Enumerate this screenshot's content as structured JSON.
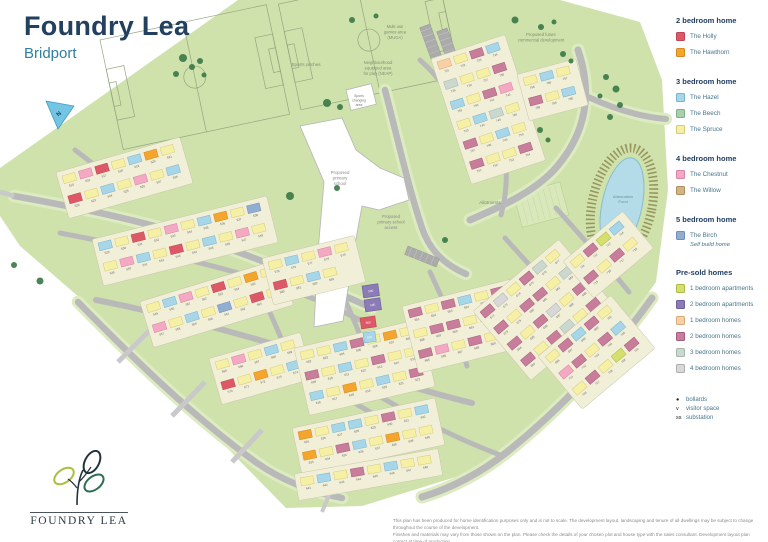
{
  "header": {
    "title": "Foundry Lea",
    "subtitle": "Bridport"
  },
  "legend": {
    "sections": [
      {
        "heading": "2 bedroom home",
        "items": [
          {
            "key": "holly",
            "label": "The Holly"
          },
          {
            "key": "hawthorn",
            "label": "The Hawthorn"
          }
        ]
      },
      {
        "heading": "3 bedroom home",
        "items": [
          {
            "key": "hazel",
            "label": "The Hazel"
          },
          {
            "key": "beech",
            "label": "The Beech"
          },
          {
            "key": "spruce",
            "label": "The Spruce"
          }
        ]
      },
      {
        "heading": "4 bedroom home",
        "items": [
          {
            "key": "chestnut",
            "label": "The Chestnut"
          },
          {
            "key": "willow",
            "label": "The Willow"
          }
        ]
      },
      {
        "heading": "5 bedroom home",
        "items": [
          {
            "key": "birch",
            "label": "The Birch",
            "note": "Self build home"
          }
        ]
      },
      {
        "heading": "Pre-sold homes",
        "items": [
          {
            "key": "p1apt",
            "label": "1 bedroom apartments"
          },
          {
            "key": "p2apt",
            "label": "2 bedroom apartments"
          },
          {
            "key": "p1home",
            "label": "1 bedroom homes"
          },
          {
            "key": "p2home",
            "label": "2 bedroom homes"
          },
          {
            "key": "p3home",
            "label": "3 bedroom homes"
          },
          {
            "key": "p4home",
            "label": "4 bedroom homes"
          }
        ]
      }
    ],
    "markers": [
      {
        "sym": "●",
        "label": "bollards"
      },
      {
        "sym": "v",
        "label": "visitor space"
      },
      {
        "sym": "ss",
        "label": "substation"
      }
    ]
  },
  "colors": {
    "holly": {
      "f": "#dd5968",
      "s": "#c04552"
    },
    "hawthorn": {
      "f": "#f3a52d",
      "s": "#d68c1c"
    },
    "hazel": {
      "f": "#a7d6e8",
      "s": "#7ab4cc"
    },
    "beech": {
      "f": "#a9cfad",
      "s": "#7fb189"
    },
    "spruce": {
      "f": "#f6f0a6",
      "s": "#d5cb79"
    },
    "chestnut": {
      "f": "#f4a9c3",
      "s": "#d884a4"
    },
    "willow": {
      "f": "#d3b384",
      "s": "#b08f5e"
    },
    "birch": {
      "f": "#91aed1",
      "s": "#6f92b8"
    },
    "p1apt": {
      "f": "#d5df6e",
      "s": "#aeba46"
    },
    "p2apt": {
      "f": "#8b7cb7",
      "s": "#6d5f9a"
    },
    "p1home": {
      "f": "#f8cfa6",
      "s": "#d9ab7c"
    },
    "p2home": {
      "f": "#c87e9b",
      "s": "#a65d7d"
    },
    "p3home": {
      "f": "#cbd8d0",
      "s": "#a4b8ab"
    },
    "p4home": {
      "f": "#d8d8d8",
      "s": "#b0b0b0"
    }
  },
  "map": {
    "green": "#cfe2ac",
    "verge": "#dcebc0",
    "road": "#b9b9b9",
    "stub": "#c9c9c9",
    "parcel": "#f2efd8",
    "parcel_edge": "#c9c5a8",
    "pond": "#b4dce8",
    "pond_edge": "#86bdd1",
    "ring": "#98975e",
    "tree": "#3c7a47",
    "pitch_line": "#96a580",
    "site_outline": "238,0 560,0 640,22 662,80 668,190 656,282 600,360 540,430 472,472 362,506 286,508 80,298 20,246 0,216 0,168",
    "school_outline": "300,126 342,118 356,150 380,168 404,178 409,200 379,210 362,206 354,250 343,321 314,327 318,252 324,182",
    "north_label": "N",
    "labels": [
      {
        "lines": [
          "Sports pitches"
        ],
        "x": 306,
        "y": 66,
        "size": 4.6,
        "color": "#7d9070"
      },
      {
        "lines": [
          "Multi use",
          "games area",
          "(MUGA)"
        ],
        "x": 395,
        "y": 28,
        "size": 4.2,
        "color": "#7d9070"
      },
      {
        "lines": [
          "Neighbourhood",
          "equipped area",
          "for play (NEAP)"
        ],
        "x": 378,
        "y": 64,
        "size": 4.2,
        "color": "#7d9070"
      },
      {
        "lines": [
          "Sports",
          "changing",
          "area"
        ],
        "x": 359,
        "y": 97,
        "size": 3.4,
        "color": "#777777",
        "box": {
          "x": 346,
          "y": 90,
          "w": 26,
          "h": 21,
          "rot": -14
        }
      },
      {
        "lines": [
          "Proposed",
          "primary",
          "school"
        ],
        "x": 340,
        "y": 174,
        "size": 4.4,
        "color": "#8a8a8a"
      },
      {
        "lines": [
          "Proposed",
          "primary school",
          "access"
        ],
        "x": 391,
        "y": 218,
        "size": 4.2,
        "color": "#8a8a8a"
      },
      {
        "lines": [
          "Proposed future",
          "commercial development"
        ],
        "x": 541,
        "y": 36,
        "size": 4.2,
        "color": "#7d9070"
      },
      {
        "lines": [
          "Allotments"
        ],
        "x": 490,
        "y": 204,
        "size": 4.6,
        "color": "#7d9070"
      },
      {
        "lines": [
          "Attenuation",
          "Pond"
        ],
        "x": 623,
        "y": 198,
        "size": 4.0,
        "color": "#6f8f99"
      }
    ],
    "roads": [
      {
        "d": "M578,50 C592,92 588,132 554,170 C532,193 502,206 470,220",
        "w": 7,
        "verge": true
      },
      {
        "d": "M586,96 C616,110 642,117 666,119",
        "w": 6,
        "verge": true
      },
      {
        "d": "M385,90 C398,140 408,186 422,228 C429,249 443,264 466,274",
        "w": 6.5,
        "verge": true
      },
      {
        "d": "M14,196 C82,208 152,223 212,243 C272,263 322,286 372,308",
        "w": 6.5,
        "verge": true
      },
      {
        "d": "M75,150 C98,167 115,182 128,198",
        "w": 5
      },
      {
        "d": "M60,233 C122,245 192,259 252,277 C300,292 330,305 360,320",
        "w": 5
      },
      {
        "d": "M96,300 C162,313 232,331 302,353 C352,369 422,391 472,403",
        "w": 6
      },
      {
        "d": "M78,302 C132,357 192,416 257,463 C283,481 312,492 342,498",
        "w": 6.5,
        "verge": true
      },
      {
        "d": "M652,298 C612,354 562,408 507,452 C482,472 452,488 422,497",
        "w": 7,
        "verge": true
      },
      {
        "d": "M250,272 C266,302 279,332 291,363",
        "w": 5
      },
      {
        "d": "M345,300 C359,331 371,361 379,396",
        "w": 5
      },
      {
        "d": "M430,272 C444,302 457,332 467,366",
        "w": 5
      },
      {
        "d": "M505,238 C532,268 560,298 585,326",
        "w": 5
      },
      {
        "d": "M556,208 C582,237 608,266 629,292",
        "w": 5
      },
      {
        "d": "M420,60 C438,76 452,95 460,119",
        "w": 5
      },
      {
        "d": "M470,56 C487,79 497,103 501,128",
        "w": 5
      },
      {
        "d": "M501,128 C508,160 508,190 501,215",
        "w": 5
      },
      {
        "d": "M292,362 C330,390 380,420 430,442",
        "w": 5
      },
      {
        "d": "M379,396 C420,420 460,440 500,455",
        "w": 5
      },
      {
        "d": "M150,330 L118,362",
        "w": 5,
        "stub": true
      },
      {
        "d": "M205,382 L172,416",
        "w": 5,
        "stub": true
      },
      {
        "d": "M262,430 L232,462",
        "w": 5,
        "stub": true
      },
      {
        "d": "M332,488 L322,512",
        "w": 4,
        "stub": true
      },
      {
        "d": "M14,196 L0,192",
        "w": 5,
        "stub": true
      }
    ],
    "parking": [
      {
        "x": 430,
        "y": 24,
        "rot": 70,
        "w": 88,
        "h": 11
      },
      {
        "x": 447,
        "y": 28,
        "rot": 70,
        "w": 88,
        "h": 11
      },
      {
        "x": 408,
        "y": 246,
        "rot": 22,
        "w": 34,
        "h": 9
      }
    ],
    "clusters": [
      {
        "name": "west-upper",
        "x": 62,
        "y": 176,
        "rot": -16,
        "rows": 2,
        "cols": 7,
        "start": 515,
        "palette": [
          "spruce",
          "chestnut",
          "holly",
          "spruce",
          "hazel",
          "hawthorn",
          "spruce",
          "holly",
          "spruce",
          "hazel",
          "spruce",
          "chestnut",
          "spruce",
          "hazel"
        ]
      },
      {
        "name": "west-mid",
        "x": 98,
        "y": 243,
        "rot": -14,
        "rows": 2,
        "cols": 10,
        "start": 529,
        "palette": [
          "hazel",
          "spruce",
          "holly",
          "spruce",
          "chestnut",
          "spruce",
          "hazel",
          "hawthorn",
          "spruce",
          "birch",
          "spruce",
          "chestnut",
          "hazel",
          "spruce",
          "holly",
          "spruce",
          "hazel",
          "spruce",
          "chestnut",
          "spruce"
        ]
      },
      {
        "name": "west-lower",
        "x": 146,
        "y": 305,
        "rot": -17,
        "rows": 2,
        "cols": 8,
        "start": 549,
        "palette": [
          "spruce",
          "hazel",
          "chestnut",
          "spruce",
          "holly",
          "spruce",
          "hawthorn",
          "spruce",
          "chestnut",
          "spruce",
          "hazel",
          "spruce",
          "birch",
          "spruce",
          "holly",
          "spruce"
        ]
      },
      {
        "name": "south-west",
        "x": 215,
        "y": 362,
        "rot": -16,
        "rows": 2,
        "cols": 5,
        "start": 565,
        "palette": [
          "spruce",
          "chestnut",
          "spruce",
          "hazel",
          "spruce",
          "holly",
          "spruce",
          "hawthorn",
          "spruce",
          "hazel"
        ]
      },
      {
        "name": "west-east-tip",
        "x": 268,
        "y": 262,
        "rot": -14,
        "rows": 2,
        "cols": 5,
        "start": 575,
        "count": 9,
        "palette": [
          "spruce",
          "hazel",
          "spruce",
          "chestnut",
          "spruce",
          "holly",
          "spruce",
          "hazel",
          "spruce"
        ]
      },
      {
        "name": "center",
        "x": 300,
        "y": 352,
        "rot": -13,
        "rows": 3,
        "cols": 7,
        "start": 602,
        "count": 21,
        "palette": [
          "spruce",
          "spruce",
          "hazel",
          "p2home",
          "spruce",
          "hawthorn",
          "spruce",
          "p2home",
          "spruce",
          "hazel",
          "spruce",
          "p2home",
          "spruce",
          "spruce",
          "hazel",
          "spruce",
          "hawthorn",
          "spruce",
          "hazel",
          "spruce",
          "p2home"
        ]
      },
      {
        "name": "bottom",
        "x": 298,
        "y": 432,
        "rot": -12,
        "rows": 2,
        "cols": 8,
        "start": 625,
        "palette": [
          "hawthorn",
          "spruce",
          "hazel",
          "hazel",
          "spruce",
          "p2home",
          "spruce",
          "hazel",
          "hawthorn",
          "spruce",
          "p2home",
          "hazel",
          "spruce",
          "hawthorn",
          "spruce",
          "spruce"
        ]
      },
      {
        "name": "bottom-row",
        "x": 300,
        "y": 478,
        "rot": -10,
        "rows": 1,
        "cols": 8,
        "start": 641,
        "palette": [
          "spruce",
          "hazel",
          "spruce",
          "p2home",
          "spruce",
          "hazel",
          "spruce",
          "spruce"
        ]
      },
      {
        "name": "east-central",
        "x": 408,
        "y": 310,
        "rot": -14,
        "rows": 3,
        "cols": 7,
        "start": 651,
        "palette": [
          "p2home",
          "spruce",
          "p2home",
          "hazel",
          "spruce",
          "p2home",
          "chestnut",
          "spruce",
          "p2home",
          "p2home",
          "spruce",
          "hazel",
          "p2home",
          "spruce",
          "p2home",
          "chestnut",
          "spruce",
          "p2home",
          "spruce",
          "p2home",
          "hazel"
        ]
      },
      {
        "name": "east",
        "x": 480,
        "y": 312,
        "rot": -40,
        "rows": 4,
        "cols": 6,
        "start": 672,
        "palette": [
          "p2home",
          "p4home",
          "spruce",
          "p2home",
          "p3home",
          "spruce",
          "p2home",
          "spruce",
          "p2home",
          "p2home",
          "spruce",
          "p3home",
          "p2home",
          "spruce",
          "p2home",
          "p4home",
          "spruce",
          "p2home",
          "p2home",
          "spruce",
          "p2home",
          "p3home",
          "spruce",
          "p2home"
        ]
      },
      {
        "name": "far-east",
        "x": 545,
        "y": 357,
        "rot": -40,
        "rows": 3,
        "cols": 5,
        "start": 696,
        "palette": [
          "spruce",
          "p2home",
          "hazel",
          "p2home",
          "spruce",
          "chestnut",
          "p2home",
          "spruce",
          "p2home",
          "hazel",
          "spruce",
          "p2home",
          "spruce",
          "p1apt",
          "p2home"
        ]
      },
      {
        "name": "north-east-small",
        "x": 570,
        "y": 262,
        "rot": -40,
        "rows": 2,
        "cols": 4,
        "start": 711,
        "palette": [
          "spruce",
          "p2home",
          "p1apt",
          "hazel",
          "p2home",
          "spruce",
          "p2home",
          "spruce"
        ]
      },
      {
        "name": "north",
        "x": 437,
        "y": 62,
        "rot": -18,
        "rows": 6,
        "cols": 4,
        "start": 731,
        "palette": [
          "p1home",
          "spruce",
          "p2home",
          "hazel",
          "p3home",
          "spruce",
          "spruce",
          "p2home",
          "hazel",
          "spruce",
          "p2home",
          "chestnut",
          "spruce",
          "hazel",
          "p3home",
          "spruce",
          "p2home",
          "spruce",
          "hazel",
          "spruce",
          "p2home",
          "spruce",
          "spruce",
          "p2home"
        ]
      },
      {
        "name": "north-small",
        "x": 523,
        "y": 78,
        "rot": -15,
        "rows": 2,
        "cols": 3,
        "start": 755,
        "palette": [
          "spruce",
          "hazel",
          "spruce",
          "p2home",
          "spruce",
          "hazel"
        ]
      }
    ],
    "blocks": [
      {
        "x": 362,
        "y": 286,
        "w": 16,
        "h": 12,
        "rot": -8,
        "key": "p2apt",
        "label": "590"
      },
      {
        "x": 364,
        "y": 300,
        "w": 16,
        "h": 12,
        "rot": -8,
        "key": "p2apt",
        "label": "595"
      },
      {
        "x": 360,
        "y": 318,
        "w": 15,
        "h": 11,
        "rot": -8,
        "key": "holly",
        "label": "600"
      },
      {
        "x": 363,
        "y": 333,
        "w": 12,
        "h": 10,
        "rot": -8,
        "key": "hazel",
        "label": "601"
      }
    ],
    "trees": [
      [
        183,
        58,
        4
      ],
      [
        192,
        67,
        3
      ],
      [
        200,
        61,
        3
      ],
      [
        176,
        74,
        3
      ],
      [
        204,
        75,
        2.5
      ],
      [
        327,
        103,
        4
      ],
      [
        340,
        107,
        3
      ],
      [
        515,
        20,
        3.5
      ],
      [
        541,
        27,
        3
      ],
      [
        554,
        22,
        2.5
      ],
      [
        563,
        54,
        3
      ],
      [
        571,
        61,
        2.5
      ],
      [
        606,
        77,
        3
      ],
      [
        616,
        89,
        3.5
      ],
      [
        600,
        96,
        2.5
      ],
      [
        620,
        105,
        3
      ],
      [
        610,
        117,
        3
      ],
      [
        290,
        196,
        4
      ],
      [
        337,
        188,
        3
      ],
      [
        445,
        240,
        3
      ],
      [
        40,
        281,
        3.5
      ],
      [
        14,
        265,
        3
      ],
      [
        540,
        130,
        3
      ],
      [
        548,
        140,
        2.5
      ],
      [
        352,
        20,
        3
      ],
      [
        376,
        16,
        2.5
      ]
    ]
  },
  "logo": {
    "text": "FOUNDRY LEA"
  },
  "footer": {
    "line1": "This plan has been produced for home identification purposes only and is not to scale. The development layout, landscaping and tenure of all dwellings may be subject to change throughout the course of the development.",
    "line2": "Finishes and materials may vary from those shown on the plan. Please check the details of your chosen plot and house type with the sales consultant. Development layout plan correct at time of production."
  }
}
